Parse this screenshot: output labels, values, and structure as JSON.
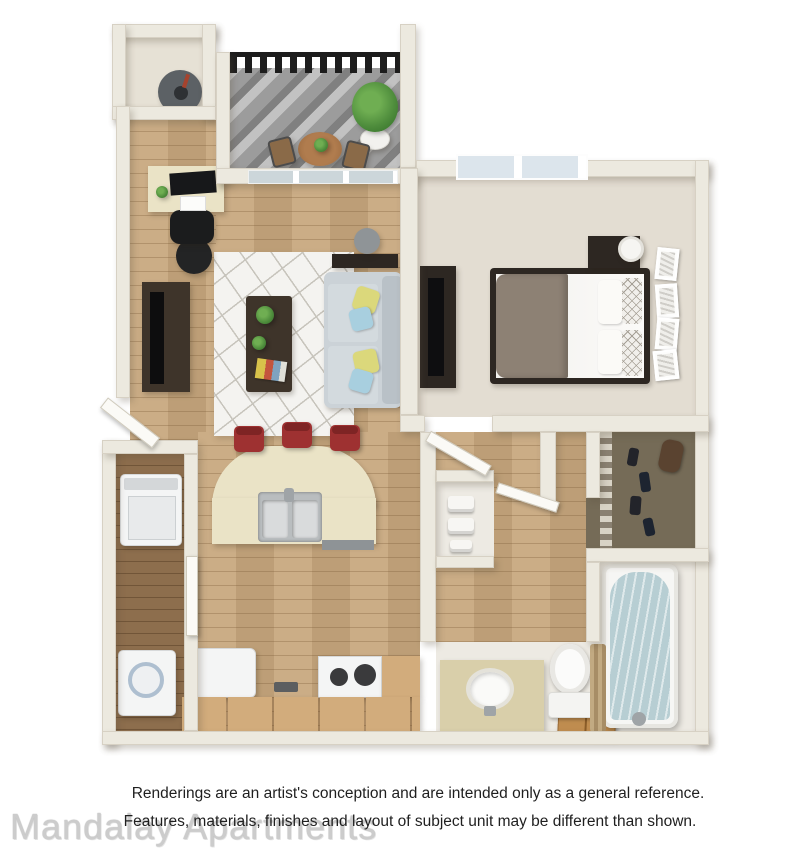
{
  "footer": {
    "line1": "Renderings are an artist's conception and are intended only as a general reference.",
    "line2": "Features, materials, finishes and layout of subject unit may be different than shown.",
    "watermark": "Mandalay Apartments"
  },
  "colors": {
    "page_bg": "#ffffff",
    "wall": "#ece9df",
    "wall_edge": "#d3cec1",
    "wood": "#c7a77d",
    "wood_dark": "#8d6e4d",
    "carpet": "#e3ddd2",
    "nook_floor": "#e6e1d5",
    "bath_floor": "#edeae3",
    "rug": "#f4f3f0",
    "rug_line": "#c7c4bc",
    "deck": "#9c9c9c",
    "railing": "#1d1d1d",
    "glass": "#ccd6da",
    "pane": "#dce5ec",
    "dark_wood": "#3e342a",
    "darker_wood": "#2d2722",
    "sofa": "#cbd2d7",
    "sofa_dark": "#b9c1c7",
    "pillow_yellow": "#dbd87b",
    "pillow_blue": "#a8cfdf",
    "bed_comforter": "#8d8174",
    "white_goods": "#f4f5f5",
    "counter_cream": "#eae3c6",
    "cabinet_tan": "#d2ac7c",
    "stool_red": "#9e3131",
    "stool_red_dark": "#7e2424",
    "water": "#b7ced3",
    "curtain_tan": "#c2aa82",
    "box_tan": "#bf8c4f",
    "closet_floor": "#756b57",
    "towel_white": "#f7f6f3",
    "plant_green": "#4e8c3c",
    "steel": "#b9bdbf",
    "text_dark": "#1f1f1f",
    "watermark_gray": "#cccccc"
  }
}
